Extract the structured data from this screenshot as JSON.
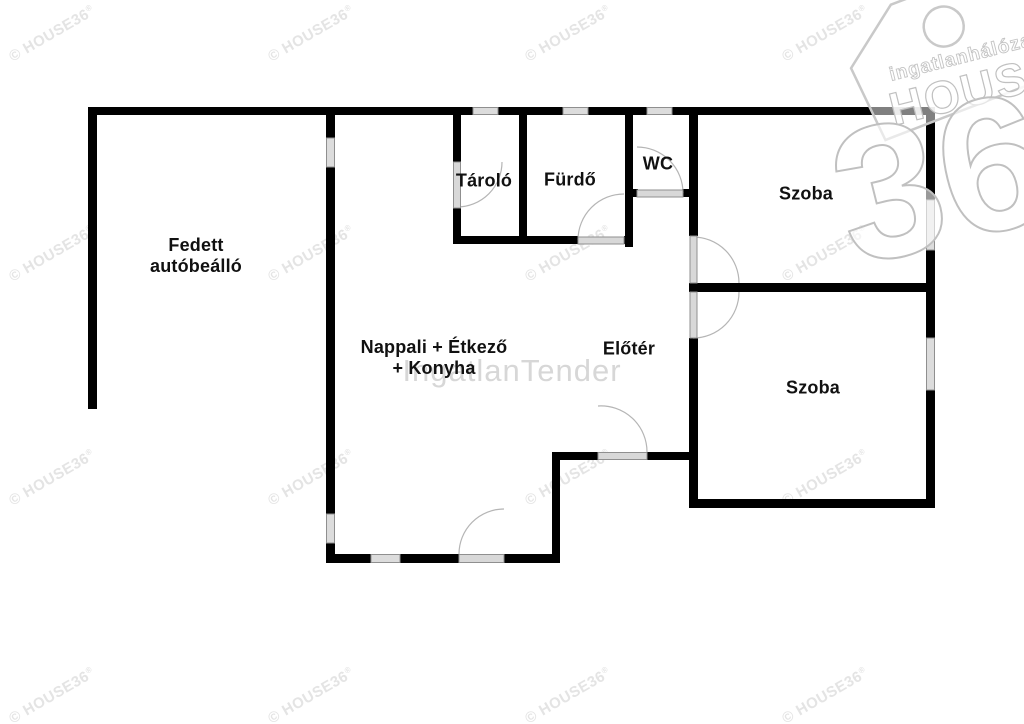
{
  "plan": {
    "type": "floor-plan",
    "rooms": [
      {
        "id": "carport",
        "name": "Fedett\nautóbeálló"
      },
      {
        "id": "storage",
        "name": "Tároló"
      },
      {
        "id": "bathroom",
        "name": "Fürdő"
      },
      {
        "id": "wc",
        "name": "WC"
      },
      {
        "id": "bedroom-1",
        "name": "Szoba"
      },
      {
        "id": "bedroom-2",
        "name": "Szoba"
      },
      {
        "id": "living-kitchen",
        "name": "Nappali + Étkező\n+ Konyha"
      },
      {
        "id": "hallway",
        "name": "Előtér"
      }
    ]
  },
  "watermark": {
    "text": "© HOUSE36",
    "registered_mark": "®",
    "color": "#e4e4e4",
    "rows": [
      34,
      254,
      478,
      696
    ],
    "cols": [
      52,
      311,
      568,
      825
    ]
  },
  "center_watermark": {
    "text": "IngatlanTender",
    "color": "#d7d7d7"
  },
  "logo": {
    "network": "ingatlanhálózat",
    "brand": "HOUSE",
    "number": "36",
    "outline_color": "#c4c4c4"
  },
  "colors": {
    "background": "#ffffff",
    "wall": "#000000",
    "window_fill": "#dcdcdc",
    "door_leaf": "#d8d8d8",
    "door_arc": "#b5b5b5",
    "label_text": "#111111"
  }
}
